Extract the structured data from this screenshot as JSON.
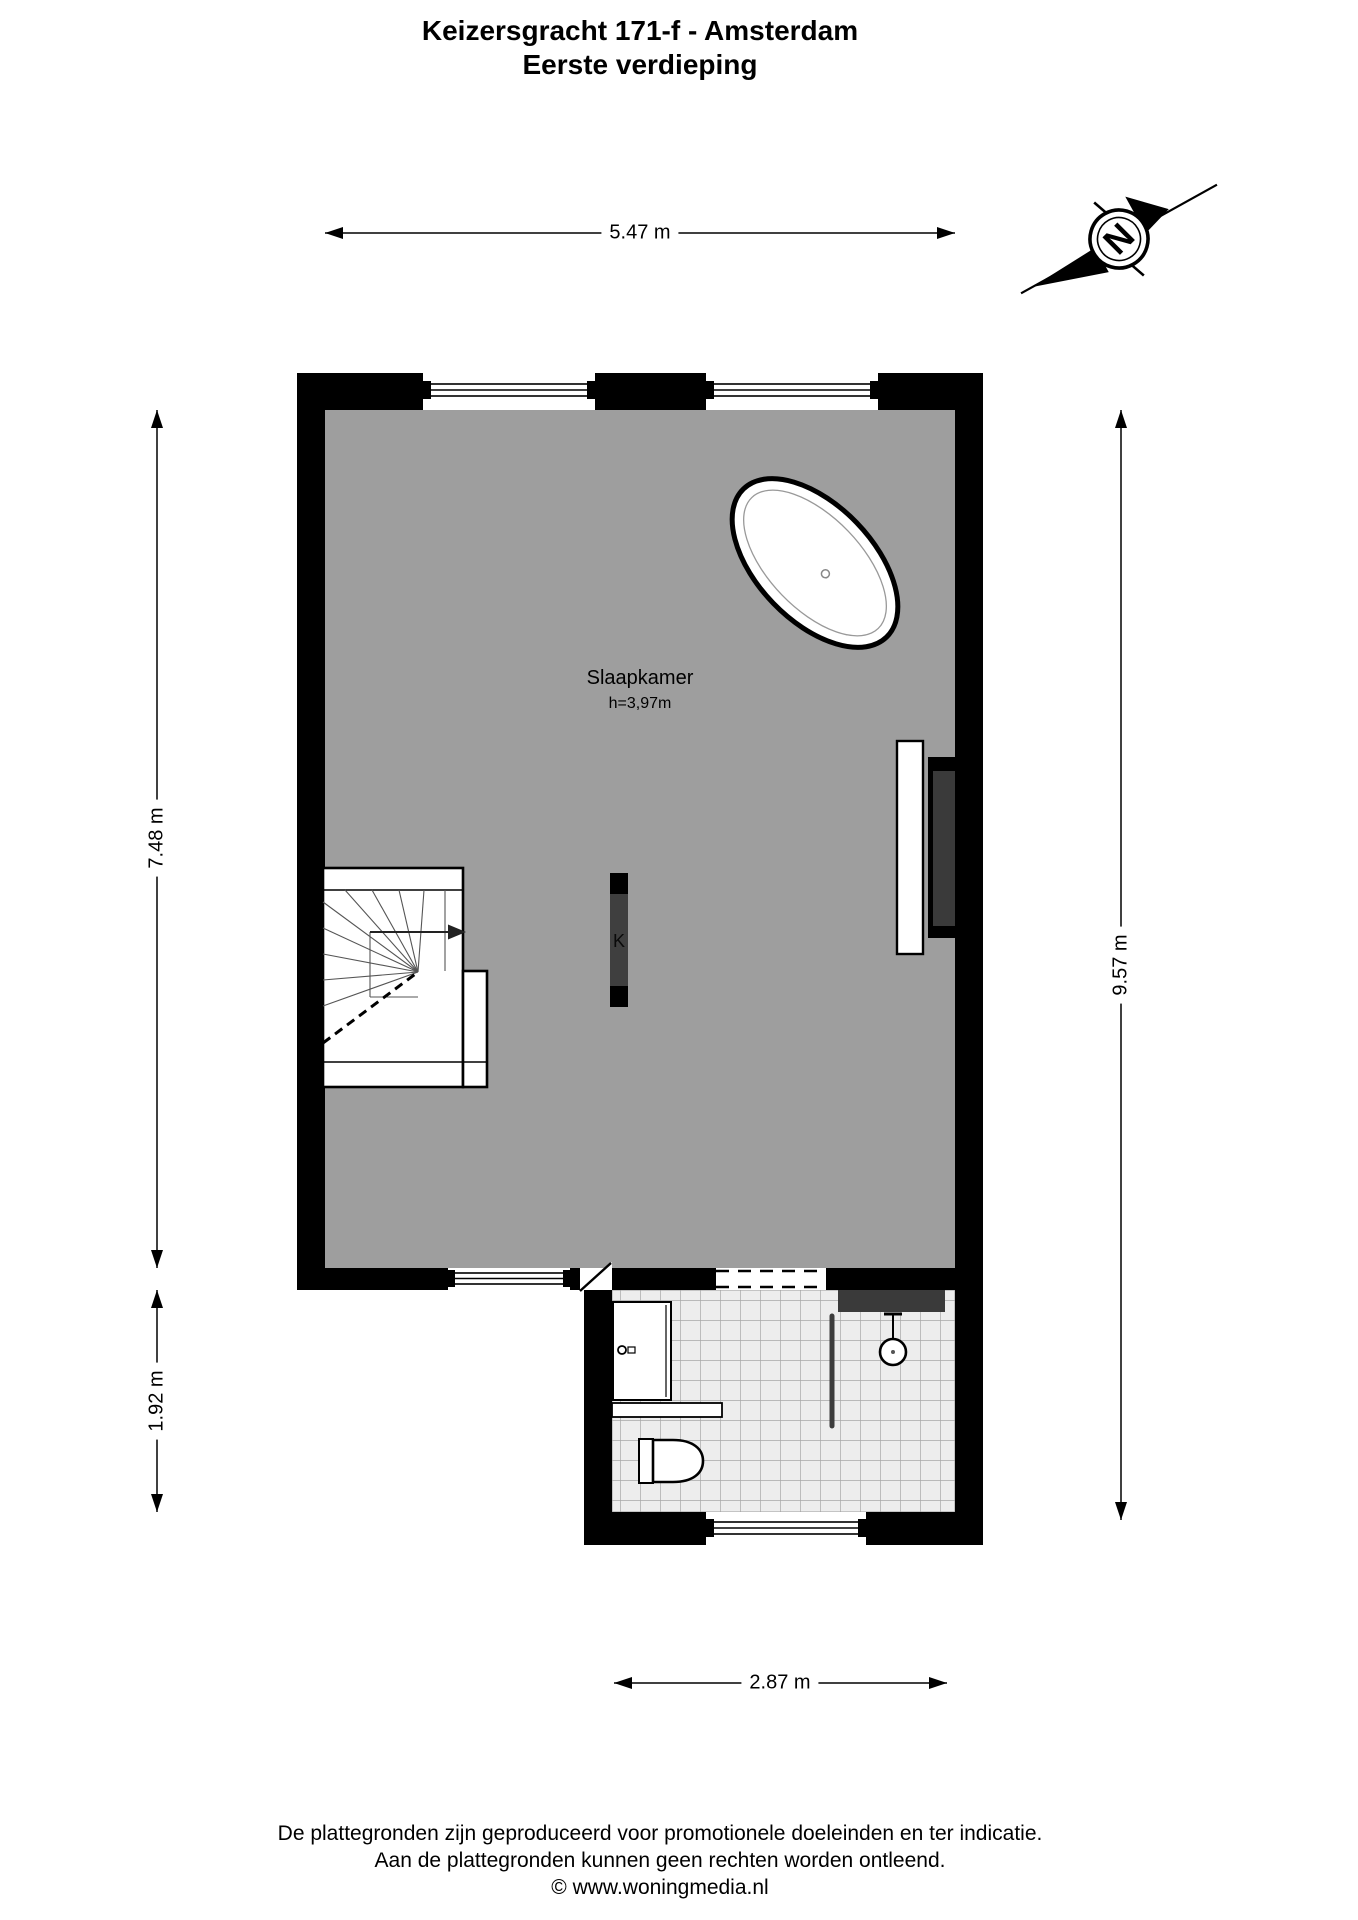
{
  "title": {
    "line1": "Keizersgracht 171-f - Amsterdam",
    "line2": "Eerste verdieping"
  },
  "compass": {
    "label": "N"
  },
  "dimensions": {
    "top": "5.47 m",
    "left_upper": "7.48 m",
    "left_lower": "1.92 m",
    "right": "9.57 m",
    "bottom": "2.87 m"
  },
  "rooms": {
    "bedroom": {
      "name": "Slaapkamer",
      "ceiling_height": "h=3,97m"
    }
  },
  "labels": {
    "column": "K"
  },
  "footer": {
    "line1": "De plattegronden zijn geproduceerd voor promotionele doeleinden en ter indicatie.",
    "line2": "Aan de plattegronden kunnen geen rechten worden ontleend.",
    "line3": "© www.woningmedia.nl"
  },
  "colors": {
    "floor_gray": "#9e9e9e",
    "wall_black": "#000000",
    "tile_fill": "#ededed",
    "tile_line": "#a8a8a8",
    "dark_fixture": "#3a3a3a"
  }
}
